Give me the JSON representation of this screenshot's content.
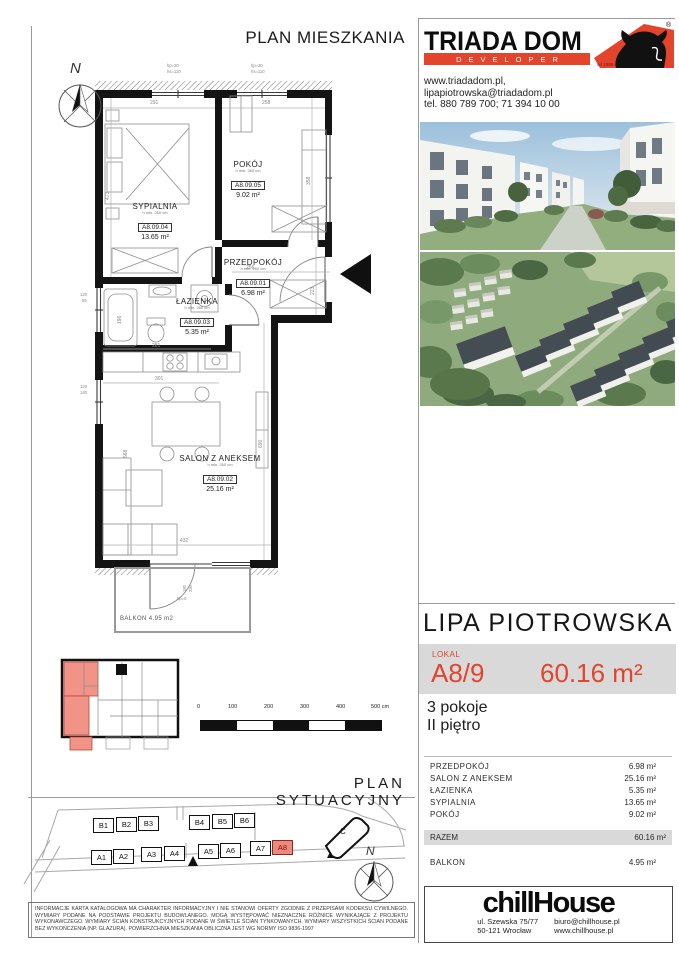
{
  "page": {
    "plan_title": "PLAN MIESZKANIA",
    "site_title": "PLAN SYTUACYJNY"
  },
  "developer": {
    "brand": "TRIADA DOM",
    "sub": "DEVELOPER",
    "reg": "®",
    "since": "od 1999 r.",
    "website": "www.triadadom.pl,",
    "email": "lipapiotrowska@triadadom.pl",
    "phone": "tel. 880 789 700; 71 394 10 00"
  },
  "offer": {
    "project": "LIPA PIOTROWSKA",
    "lokal_label": "LOKAL",
    "unit": "A8/9",
    "area": "60.16 m²",
    "rooms": "3 pokoje",
    "floor": "II piętro"
  },
  "areas": {
    "rows": [
      {
        "label": "PRZEDPOKÓJ",
        "value": "6.98 m²"
      },
      {
        "label": "SALON Z ANEKSEM",
        "value": "25.16 m²"
      },
      {
        "label": "ŁAZIENKA",
        "value": "5.35 m²"
      },
      {
        "label": "SYPIALNIA",
        "value": "13.65 m²"
      },
      {
        "label": "POKÓJ",
        "value": "9.02 m²"
      }
    ],
    "total_label": "RAZEM",
    "total_value": "60.16 m²",
    "balcony_label": "BALKON",
    "balcony_value": "4.95 m²"
  },
  "plan": {
    "compass": "N",
    "rooms": [
      {
        "name": "SYPIALNIA",
        "h": "h min. 260 cm",
        "code": "A8.09.04",
        "area": "13.65  m²"
      },
      {
        "name": "POKÓJ",
        "h": "h min. 260 cm",
        "code": "A8.09.05",
        "area": "9.02   m²"
      },
      {
        "name": "PRZEDPOKÓJ",
        "h": "h min. 260 cm",
        "code": "A8.09.01",
        "area": "6.98   m²"
      },
      {
        "name": "ŁAZIENKA",
        "h": "h min. 260 cm",
        "code": "A8.09.03",
        "area": "5.35   m²"
      },
      {
        "name": "SALON Z ANEKSEM",
        "h": "h min. 260 cm",
        "code": "A8.09.02",
        "area": "25.16  m²"
      }
    ],
    "balcony_label": "BALKON  4.95 m2",
    "dims": {
      "sypialnia_w": "291",
      "pokoj_w": "258",
      "sypialnia_h": "473",
      "pokoj_h": "358",
      "przedpokoj_w": "256",
      "przedpokoj_h": "223",
      "tub": "196",
      "kitchen_a": "281",
      "kitchen_b": "301",
      "salon_w": "432",
      "salon_h": "690",
      "salon_h2": "568",
      "win_hp": "hp=20",
      "win_hs": "hs=110",
      "left_a": "120",
      "left_b": "55",
      "left2_a": "120",
      "left2_b": "140",
      "bal_a": "180",
      "bal_b": "230",
      "bal_hp": "hp=0"
    }
  },
  "scalebar": {
    "ticks": [
      "0",
      "100",
      "200",
      "300",
      "400",
      "500 cm"
    ]
  },
  "siteplan": {
    "compass": "N",
    "blocks_b": [
      "B1",
      "B2",
      "B3",
      "B4",
      "B5",
      "B6"
    ],
    "blocks_a": [
      "A1",
      "A2",
      "A3",
      "A4",
      "A5",
      "A6",
      "A7",
      "A8"
    ],
    "building_c": "C",
    "highlight": "A8"
  },
  "agency": {
    "name": "chillHouse",
    "address1": "ul. Szewska 75/77",
    "address2": "50-121 Wrocław",
    "email": "biuro@chillhouse.pl",
    "web": "www.chillhouse.pl"
  },
  "legal": {
    "text": "INFORMACJE KARTA KATALOGOWA MA CHARAKTER INFORMACYJNY I NIE STANOWI OFERTY ZGODNIE Z PRZEPISAMI KODEKSU CYWILNEGO. WYMIARY PODANE NA PODSTAWIE PROJEKTU BUDOWLANEGO. MOGĄ WYSTĘPOWAĆ NIEZNACZNE RÓŻNICE WYNIKAJĄCE Z PROJEKTU WYKONAWCZEGO. WYMIARY ŚCIAN KONSTRUKCYJNYCH PODANE W ŚWIETLE ŚCIAN TYNKOWANYCH. WYMIARY WSZYSTKICH ŚCIAN PODANE BEZ WYKOŃCZENIA (NP. GLAZURA). POWIERZCHNIA MIESZKANIA OBLICZNA JEST WG NORMY ISO 9836-1997"
  },
  "colors": {
    "accent": "#e2442c",
    "unit_highlight": "#f0897d",
    "band_gray": "#d9d9d9"
  }
}
